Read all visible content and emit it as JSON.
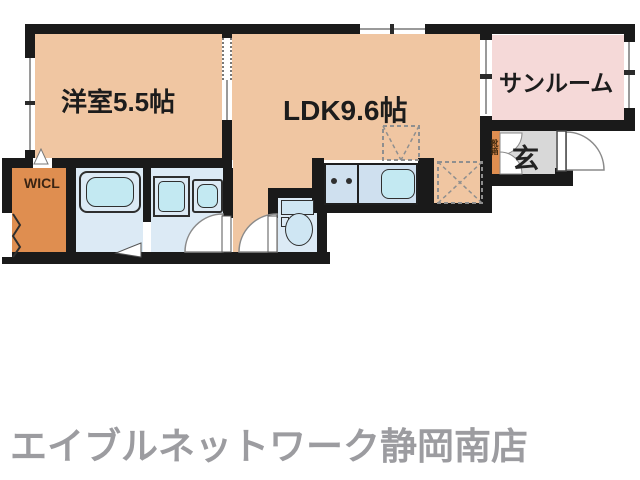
{
  "floor_plan": {
    "rooms": {
      "western_room": {
        "label": "洋室5.5帖"
      },
      "ldk": {
        "label": "LDK9.6帖"
      },
      "sunroom": {
        "label": "サンルーム"
      },
      "entrance": {
        "label": "玄"
      },
      "walk_in_closet": {
        "label": "WICL"
      },
      "shoe_box": {
        "label": "靴箱"
      }
    },
    "fixtures": [
      "bathtub",
      "washing-machine",
      "vanity-sink",
      "toilet",
      "kitchen-counter",
      "kitchen-sink",
      "stove-burners",
      "refrigerator-space",
      "washer-space"
    ],
    "colors": {
      "room_peach": "#f0c6a2",
      "sunroom_pink": "#f5d9d8",
      "closet_orange": "#df8e50",
      "water_room_blue": "#dceaf5",
      "fixture_cyan": "#c3e9f2",
      "counter_blue": "#cfe0ef",
      "entrance_gray": "#d8d8d8",
      "wall_black": "#1a1a1a",
      "footer_gray": "#9c9ca0"
    }
  },
  "footer": {
    "store_name": "エイブルネットワーク静岡南店"
  }
}
